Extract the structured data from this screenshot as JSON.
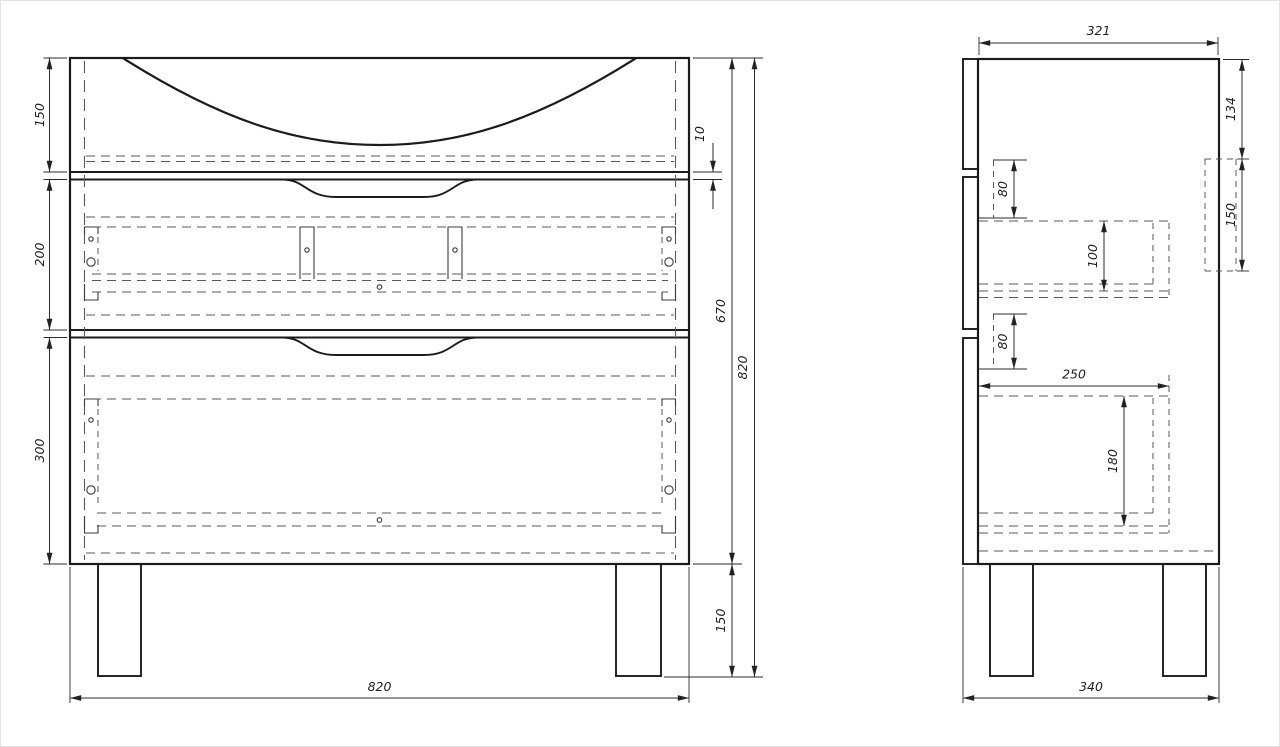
{
  "drawing": {
    "type": "technical-drawing",
    "subject": "vanity-cabinet-two-drawers",
    "colors": {
      "background": "#ffffff",
      "main_line": "#1b1b1b",
      "hidden_line": "#5a5a5a",
      "dimension_line": "#2b2b2b"
    },
    "front_view": {
      "dims": {
        "top_section_height": "150",
        "middle_section_height": "200",
        "bottom_section_height": "300",
        "top_reveal_gap": "10",
        "carcass_height": "670",
        "overall_height": "820",
        "leg_height": "150",
        "overall_width": "820"
      }
    },
    "side_view": {
      "dims": {
        "inner_depth": "321",
        "back_top_offset": "134",
        "back_panel_height": "150",
        "drawer1_front_overlap": "80",
        "drawer1_box_height": "100",
        "drawer2_front_overlap": "80",
        "drawer2_box_depth": "250",
        "drawer2_box_height": "180",
        "overall_depth": "340"
      }
    }
  }
}
